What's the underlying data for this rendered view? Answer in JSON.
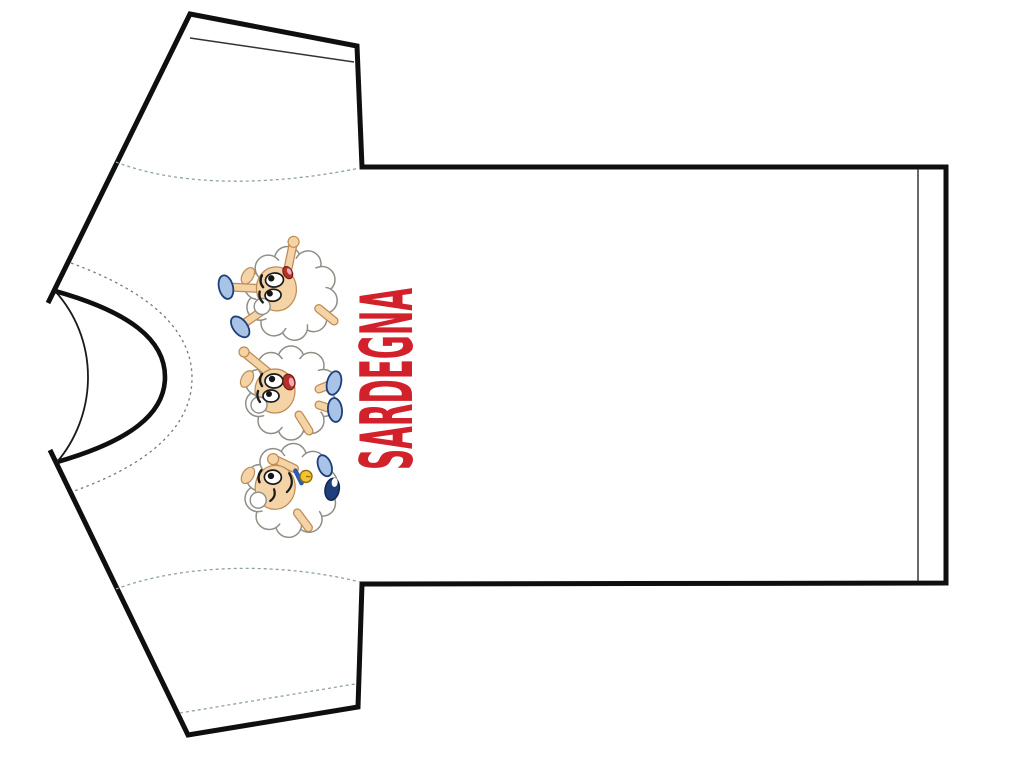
{
  "page": {
    "background_color": "#ffffff"
  },
  "shirt": {
    "fabric_color": "#ffffff",
    "outline_color": "#0f0f0f",
    "stitch_color": "#8fa39b"
  },
  "print": {
    "text": "SARDEGNA",
    "text_color": "#D2212B",
    "mascots": [
      {
        "name": "sheep-cheering-icon",
        "wool_color": "#ffffff",
        "shoe_color": "#A9C3E6"
      },
      {
        "name": "sheep-laughing-icon",
        "wool_color": "#ffffff",
        "shoe_color": "#A9C3E6"
      },
      {
        "name": "sheep-winking-bell-icon",
        "wool_color": "#ffffff",
        "bell_color": "#F3C42F"
      }
    ],
    "skin_color": "#F4D3A7"
  }
}
